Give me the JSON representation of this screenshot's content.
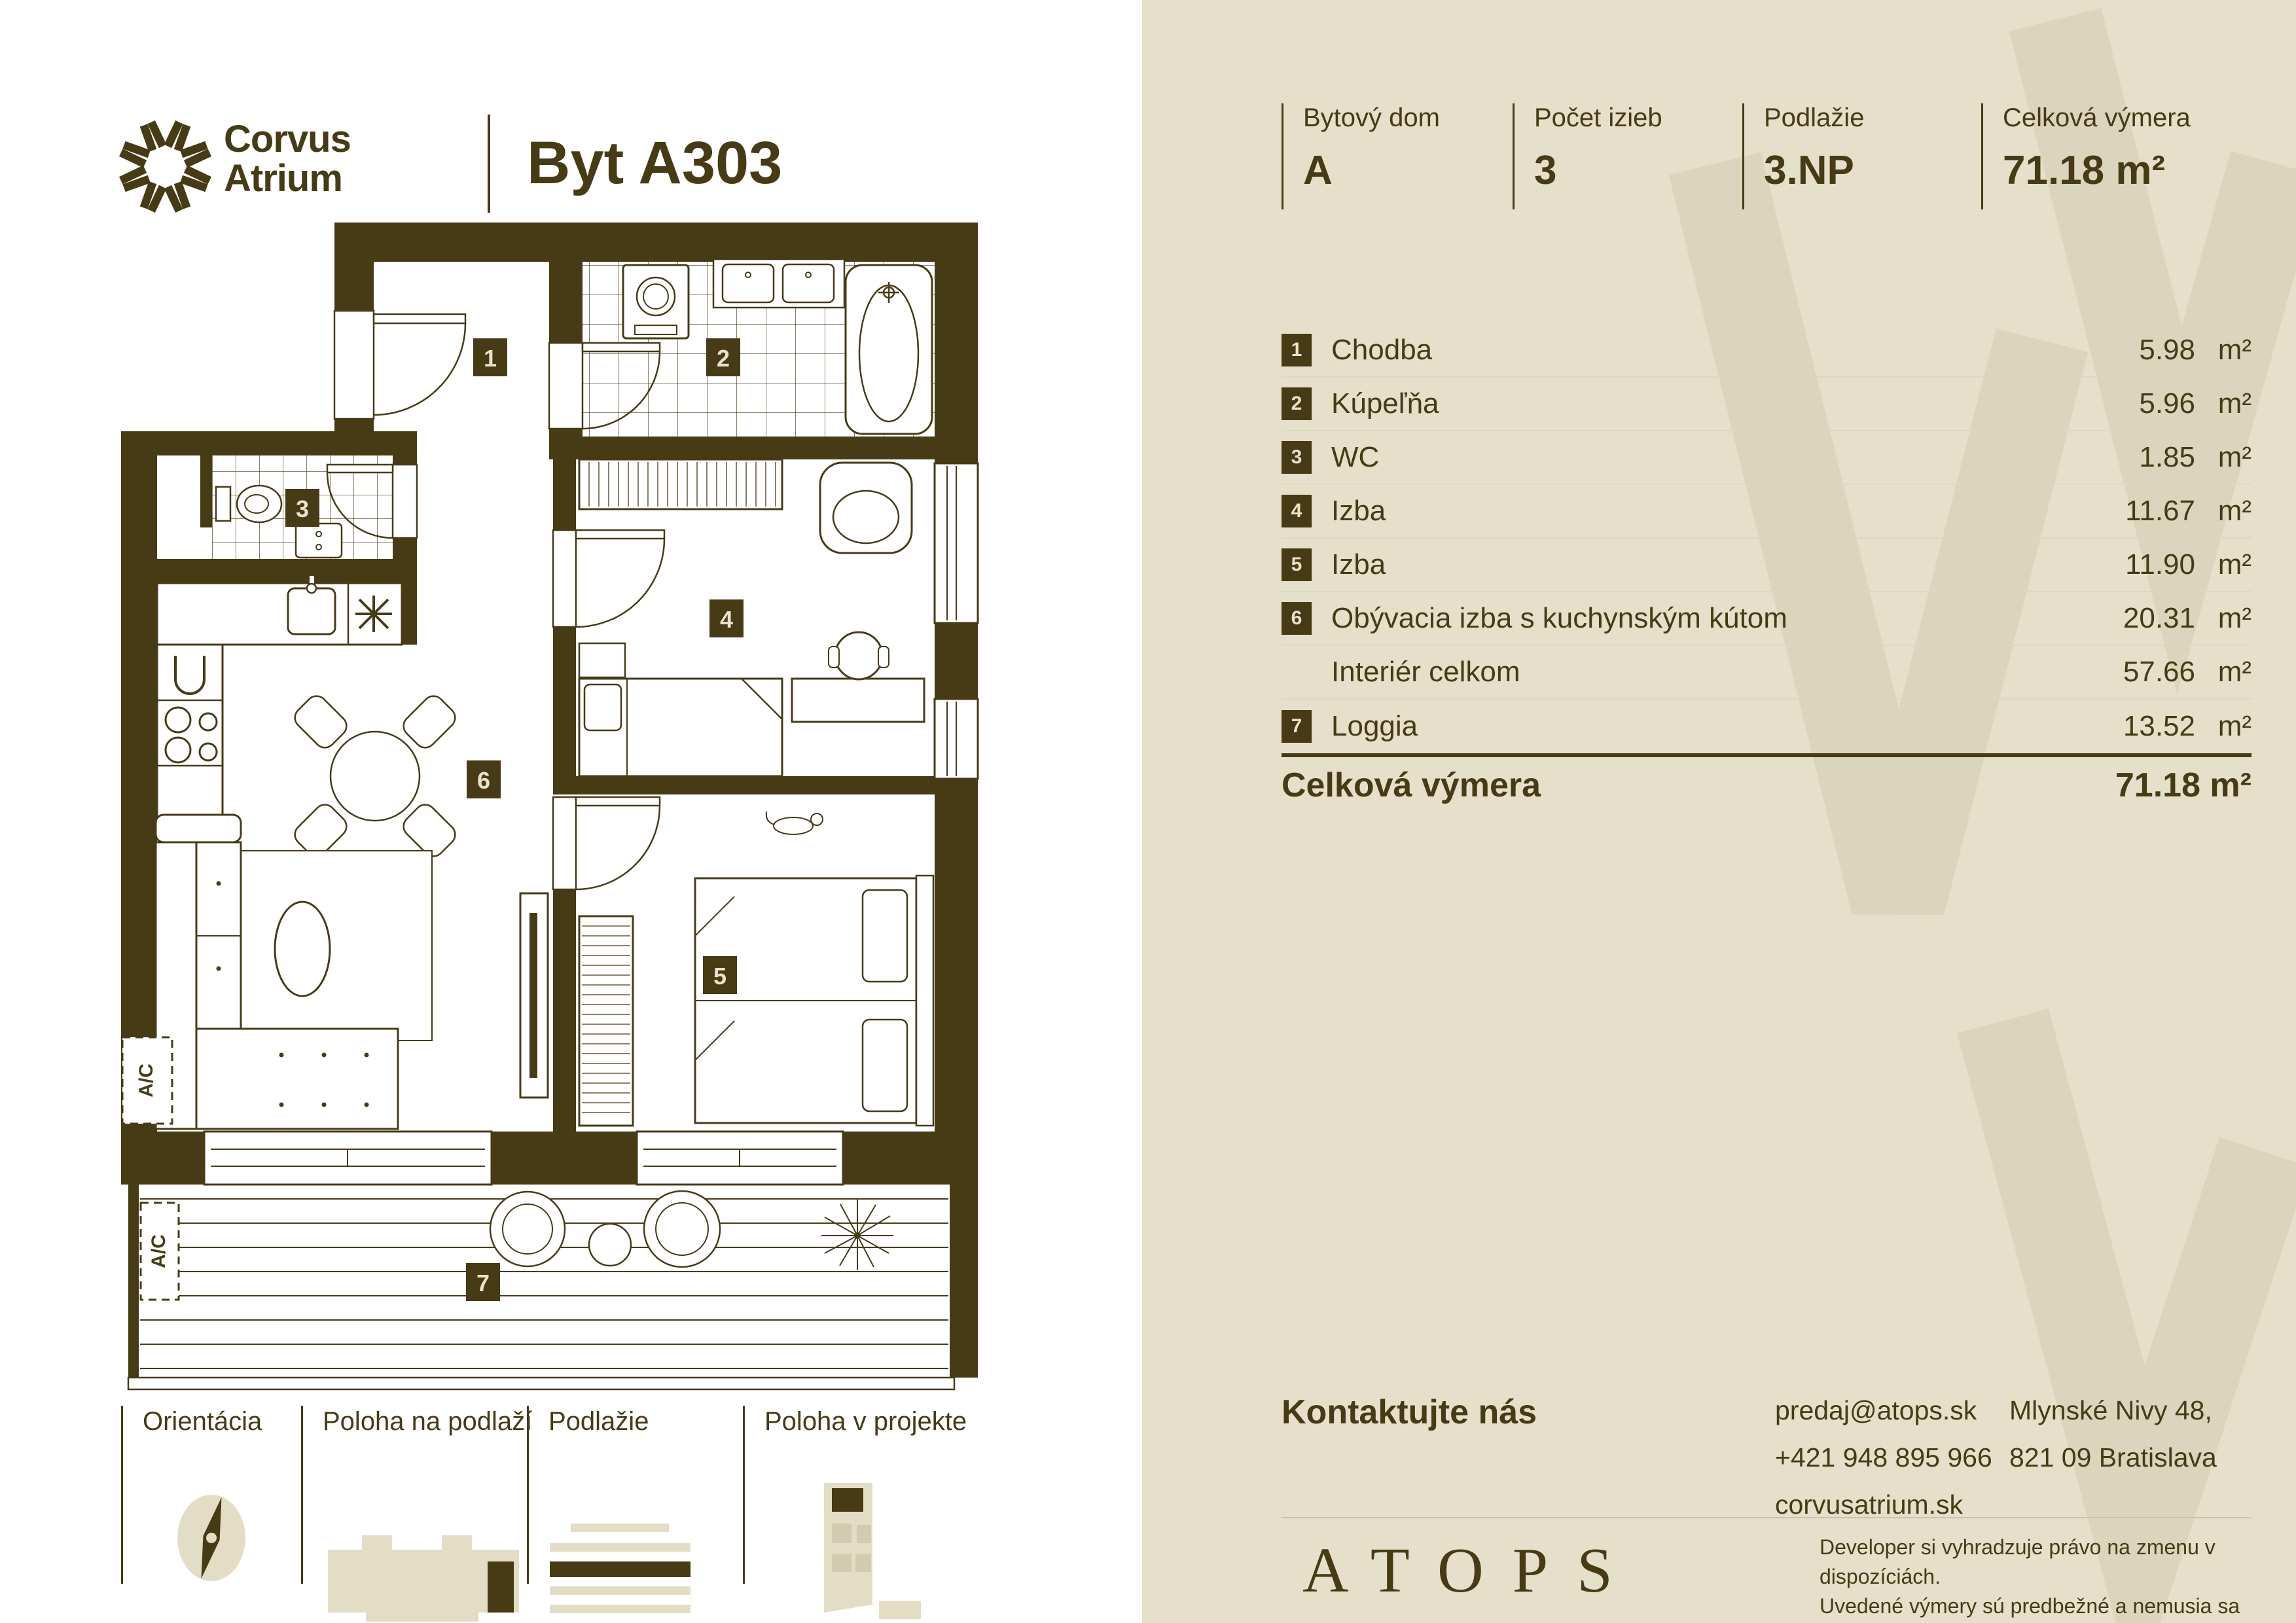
{
  "brand": {
    "name_line1": "Corvus",
    "name_line2": "Atrium",
    "unit_title": "Byt A303"
  },
  "header_stats": [
    {
      "label": "Bytový dom",
      "value": "A"
    },
    {
      "label": "Počet izieb",
      "value": "3"
    },
    {
      "label": "Podlažie",
      "value": "3.NP"
    },
    {
      "label": "Celková výmera",
      "value": "71.18 m²"
    }
  ],
  "rooms": [
    {
      "num": "1",
      "label": "Chodba",
      "area": "5.98",
      "unit": "m²"
    },
    {
      "num": "2",
      "label": "Kúpeľňa",
      "area": "5.96",
      "unit": "m²"
    },
    {
      "num": "3",
      "label": "WC",
      "area": "1.85",
      "unit": "m²"
    },
    {
      "num": "4",
      "label": "Izba",
      "area": "11.67",
      "unit": "m²"
    },
    {
      "num": "5",
      "label": "Izba",
      "area": "11.90",
      "unit": "m²"
    },
    {
      "num": "6",
      "label": "Obývacia izba s kuchynským kútom",
      "area": "20.31",
      "unit": "m²"
    },
    {
      "num": "",
      "label": "Interiér celkom",
      "area": "57.66",
      "unit": "m²"
    },
    {
      "num": "7",
      "label": "Loggia",
      "area": "13.52",
      "unit": "m²"
    }
  ],
  "total": {
    "label": "Celková výmera",
    "value": "71.18 m²"
  },
  "contact": {
    "heading": "Kontaktujte nás",
    "email": "predaj@atops.sk",
    "phone": "+421 948 895 966",
    "website": "corvusatrium.sk",
    "address_line1": "Mlynské Nivy 48,",
    "address_line2": "821 09 Bratislava"
  },
  "developer": {
    "logo": "ATOPS",
    "disclaimer_line1": "Developer si vyhradzuje právo na zmenu v dispozíciách.",
    "disclaimer_line2": "Uvedené výmery sú predbežné a nemusia sa zhodovať",
    "disclaimer_line3": "so skutočným stavom projektu po jeho realizácii."
  },
  "legend": [
    {
      "label": "Orientácia"
    },
    {
      "label": "Poloha na podlaží"
    },
    {
      "label": "Podlažie"
    },
    {
      "label": "Poloha v projekte"
    }
  ],
  "plan": {
    "badges": [
      "1",
      "2",
      "3",
      "4",
      "5",
      "6",
      "7"
    ],
    "ac_label": "A/C"
  },
  "colors": {
    "ink": "#473B16",
    "panel": "#E6DFCA",
    "watermark": "#DCD5BE",
    "badge_text": "#E9E2CC"
  }
}
